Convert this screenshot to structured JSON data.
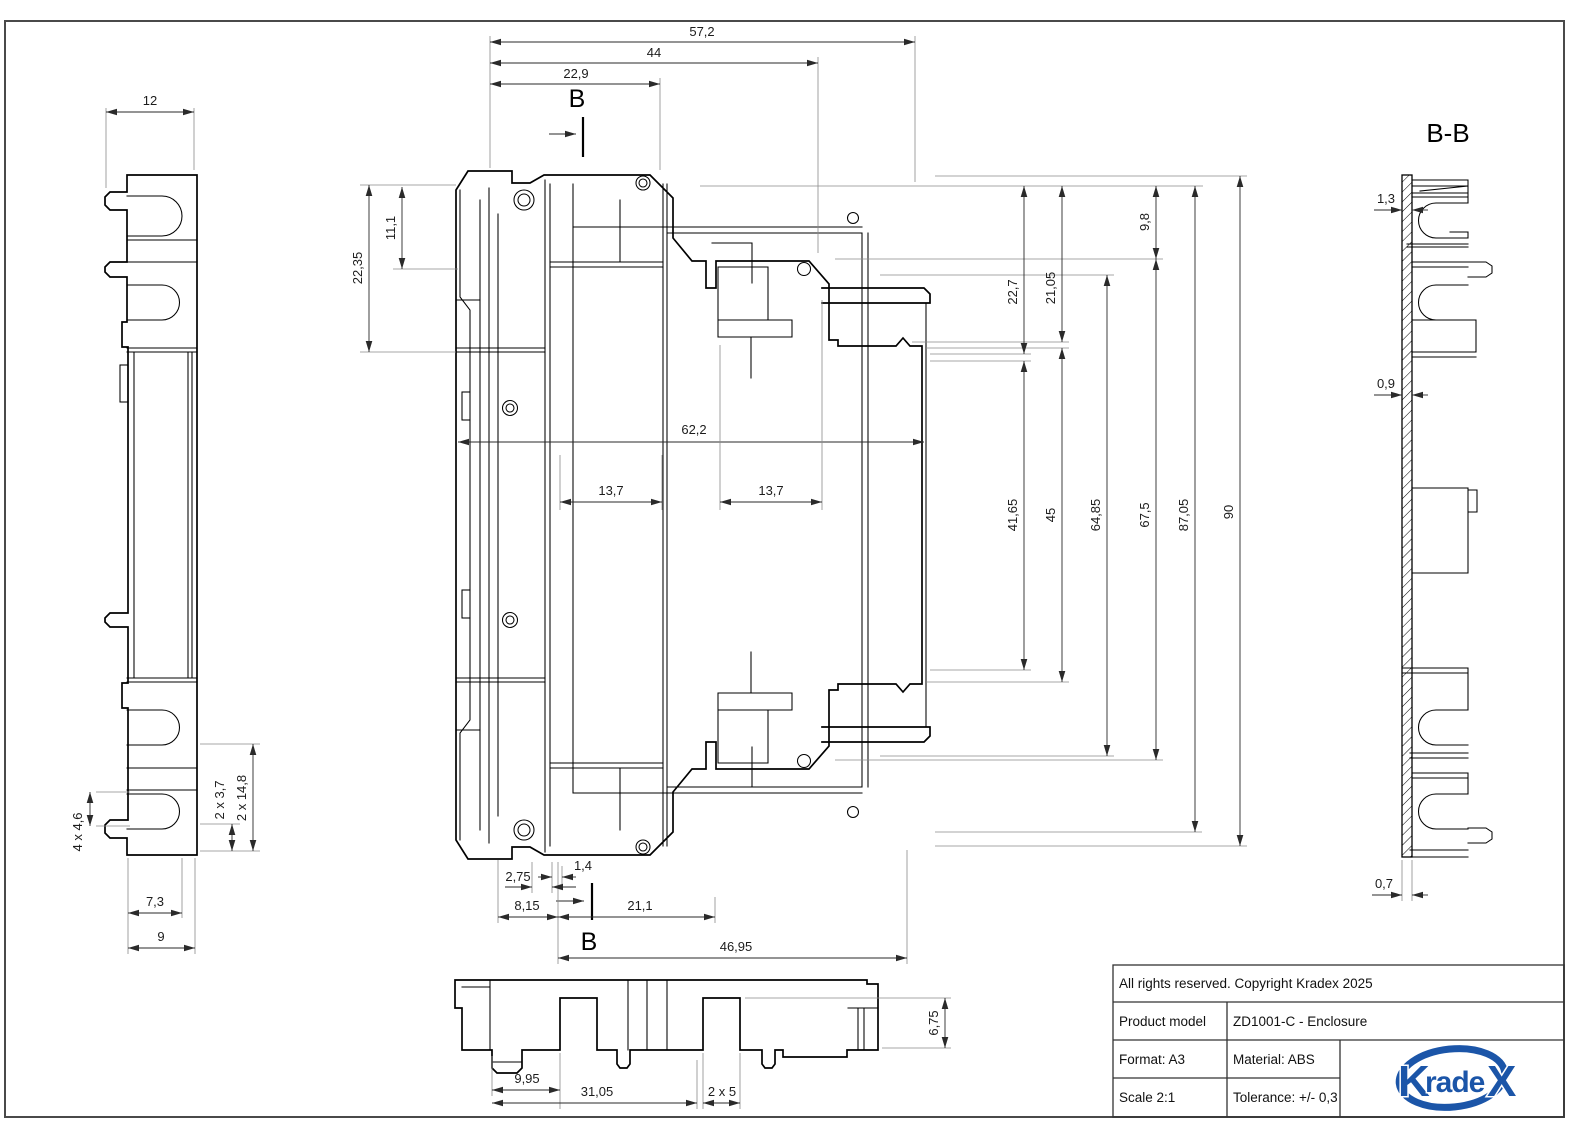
{
  "title_block": {
    "copyright": "All rights reserved. Copyright Kradex 2025",
    "product_label": "Product model",
    "product_value": "ZD1001-C - Enclosure",
    "format": "Format: A3",
    "material": "Material: ABS",
    "scale": "Scale 2:1",
    "tolerance": "Tolerance: +/- 0,3",
    "logo": {
      "k": "K",
      "mid": "rade",
      "x": "X"
    },
    "logo_color": "#1b55a8"
  },
  "sections": {
    "cut_label_top": "B",
    "cut_label_bottom": "B",
    "section_view_title": "B-B"
  },
  "dims": {
    "left_view": {
      "width": "12",
      "tabs": "4 x 4,6",
      "slot": "2 x 3,7",
      "slot_pitch": "2 x 14,8",
      "inner_width": "7,3",
      "depth": "9"
    },
    "main_view": {
      "w572": "57,2",
      "w44": "44",
      "w229": "22,9",
      "h2235": "22,35",
      "h111": "11,1",
      "w622": "62,2",
      "w137l": "13,7",
      "w137r": "13,7",
      "h98": "9,8",
      "h2105": "21,05",
      "h227": "22,7",
      "h4165": "41,65",
      "h45": "45",
      "h6485": "64,85",
      "h675": "67,5",
      "h8705": "87,05",
      "h90": "90",
      "w275": "2,75",
      "w14": "1,4",
      "w815": "8,15",
      "w211": "21,1",
      "w4695": "46,95"
    },
    "section_view": {
      "t13": "1,3",
      "t09": "0,9",
      "t07": "0,7"
    },
    "bottom_view": {
      "w995": "9,95",
      "w3105": "31,05",
      "w2x5": "2 x 5",
      "h675": "6,75"
    }
  }
}
